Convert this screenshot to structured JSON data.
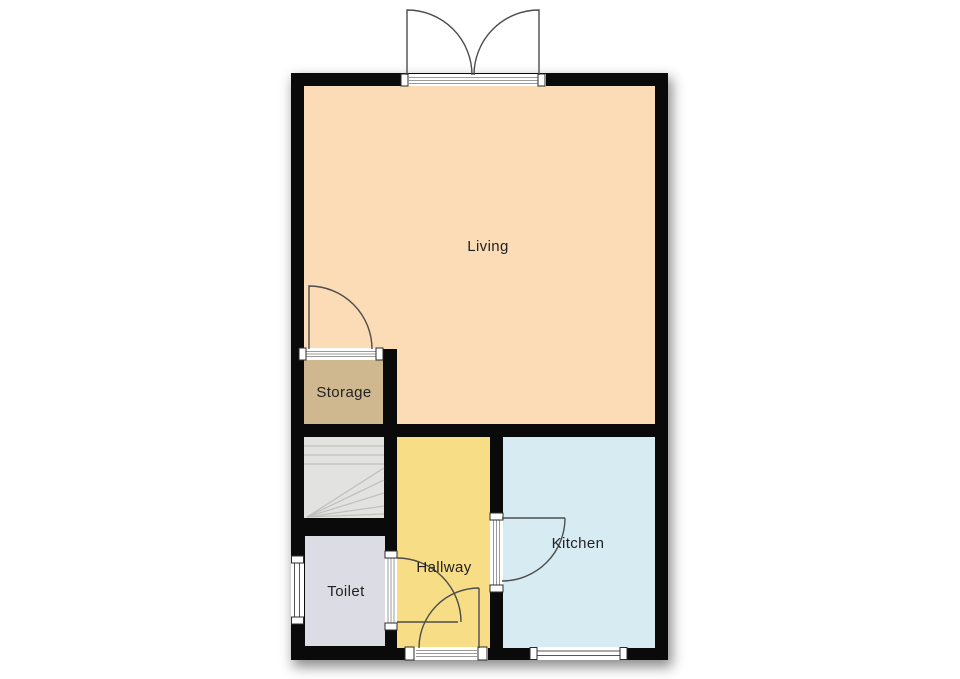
{
  "page": {
    "background": "#ffffff"
  },
  "rooms": {
    "living": {
      "label": "Living",
      "color": "#fbdcb6"
    },
    "storage": {
      "label": "Storage",
      "color": "#cfb78f"
    },
    "stairs": {
      "color": "#e2e2e0"
    },
    "toilet": {
      "label": "Toilet",
      "color": "#dcdce4"
    },
    "hallway": {
      "label": "Hallway",
      "color": "#f6dd86"
    },
    "kitchen": {
      "label": "Kitchen",
      "color": "#d6ecf2"
    }
  },
  "colors": {
    "wall": "#0a0a0a",
    "door_swing": "#4d4d4d",
    "stair_line": "#bfbfbd",
    "threshold_stripe": "#9a9a9a",
    "window_line": "#555555",
    "frame_outline": "#2b2b2b",
    "label_text": "#222222"
  }
}
